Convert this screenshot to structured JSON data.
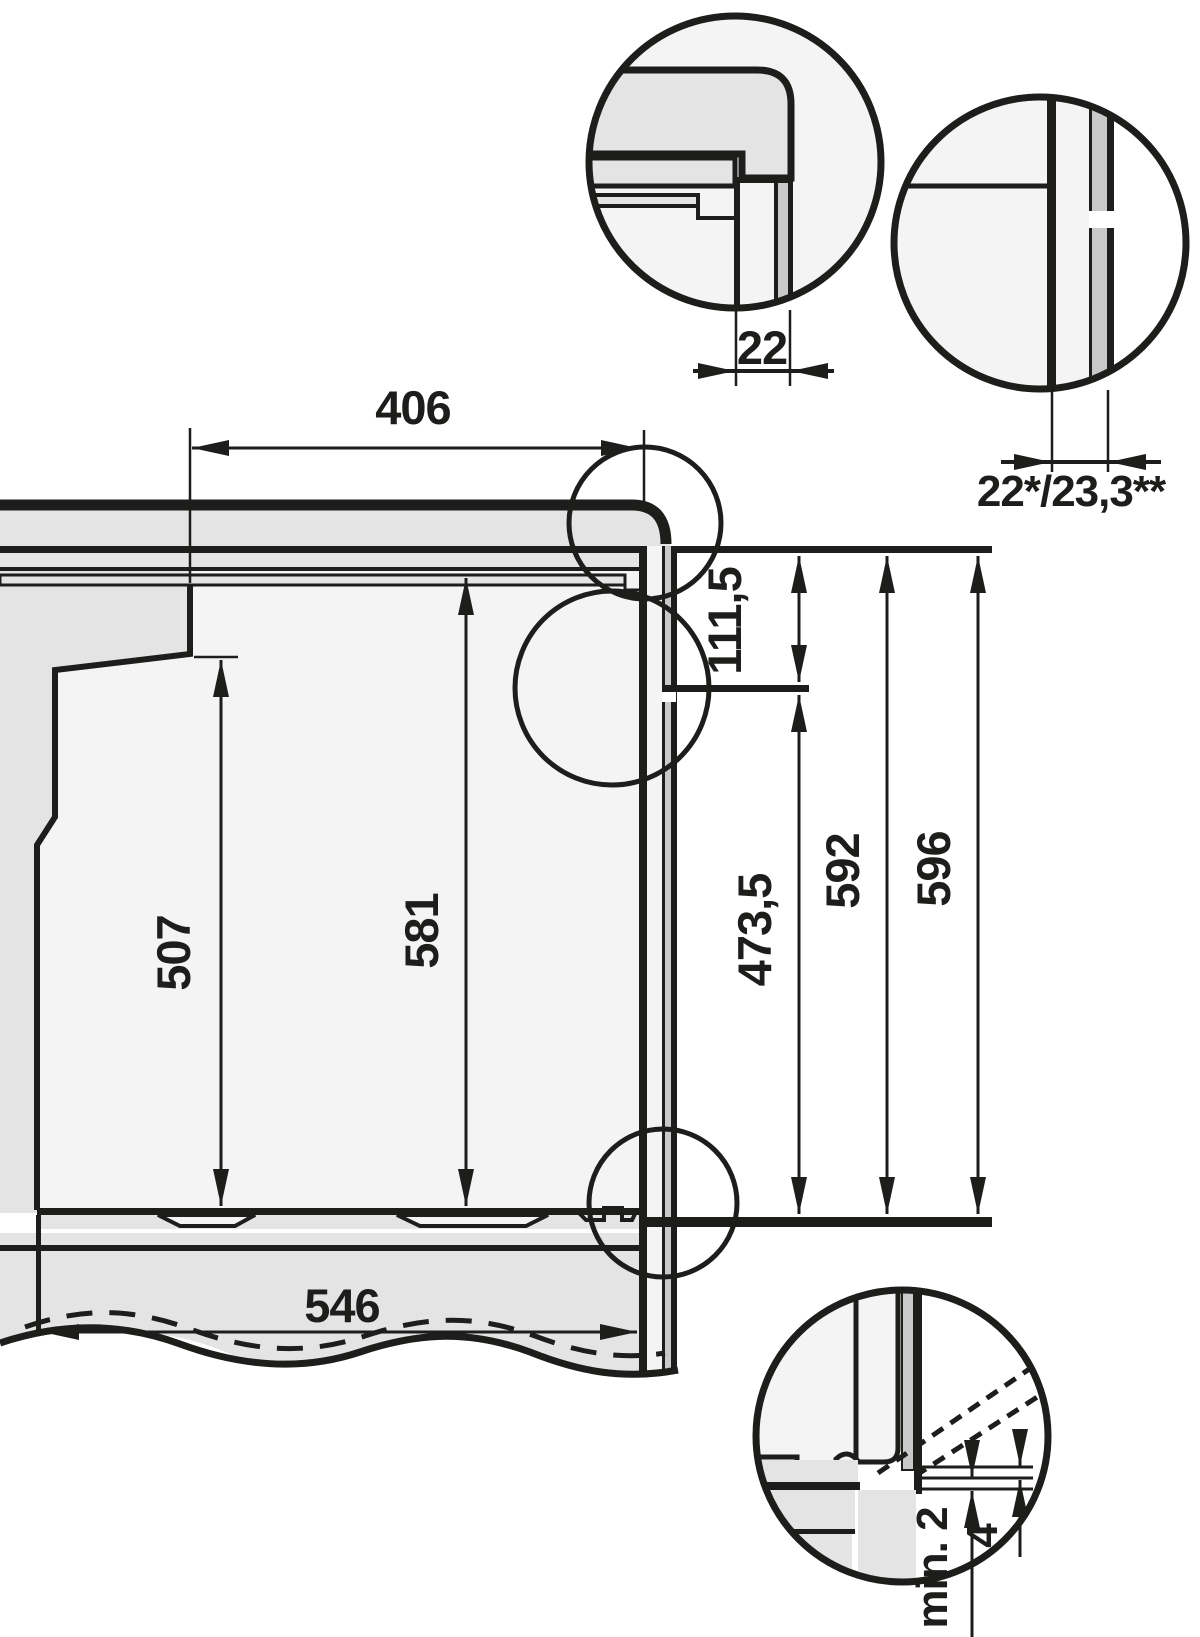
{
  "diagram": {
    "kind": "built-in appliance installation section drawing",
    "units_note": "millimetres",
    "colors": {
      "line": "#1d1d1b",
      "panel_gray": "#e4e4e4",
      "strip_gray": "#c9c9c9",
      "cavity_white": "#f4f4f4",
      "background": "#ffffff"
    },
    "dimensions": {
      "niche_top_depth": {
        "label": "406"
      },
      "door_thickness_detail": {
        "label": "22"
      },
      "front_depth_variants": {
        "label": "22*/23,3**"
      },
      "control_panel_height": {
        "label": "111,5"
      },
      "door_front_height": {
        "label": "473,5"
      },
      "appliance_height": {
        "label": "592"
      },
      "appliance_height_total": {
        "label": "596"
      },
      "cavity_rear_height": {
        "label": "507"
      },
      "cavity_front_height": {
        "label": "581"
      },
      "bottom_depth": {
        "label": "546"
      },
      "bottom_clearance_min": {
        "label": "min. 2"
      },
      "bottom_gap": {
        "label": "4"
      }
    }
  }
}
